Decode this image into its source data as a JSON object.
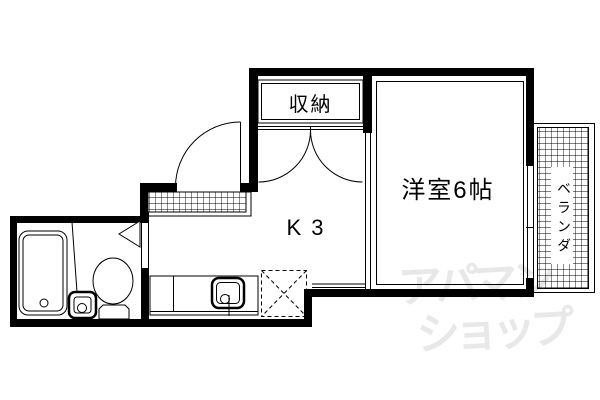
{
  "floorplan": {
    "labels": {
      "closet": "収納",
      "western_room": "洋室6帖",
      "kitchen": "K 3",
      "veranda": "ベランダ"
    },
    "watermark": {
      "line1": "アパマン",
      "line2": "ショップ",
      "color": "#e8e8e8"
    },
    "colors": {
      "line": "#000000",
      "background": "#ffffff"
    },
    "fixtures": [
      "bathtub",
      "washbasin",
      "toilet",
      "bathroom-door",
      "entrance-door",
      "entrance-porch",
      "closet-double-door",
      "kitchen-counter",
      "kitchen-sink",
      "washing-machine-space",
      "window",
      "veranda-deck"
    ]
  }
}
